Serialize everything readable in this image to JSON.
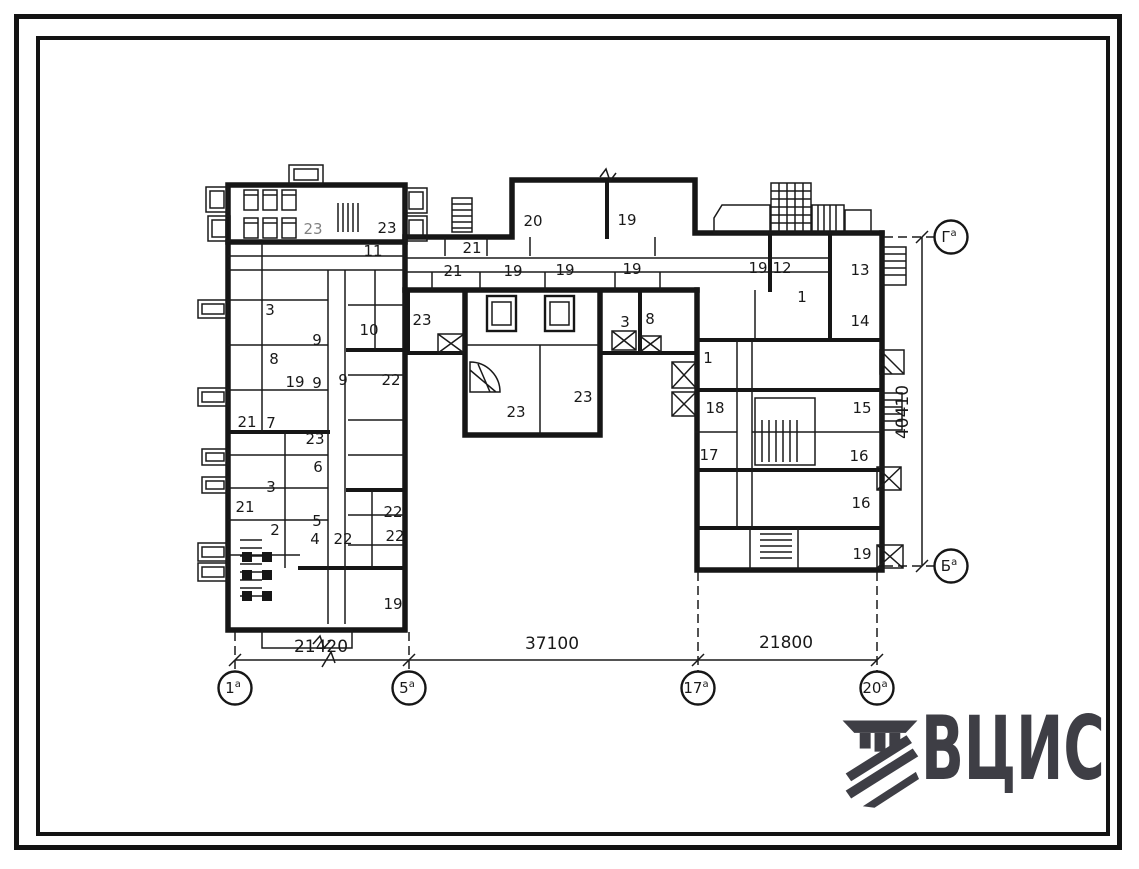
{
  "colors": {
    "ink": "#161616",
    "logo": "#3e3e45"
  },
  "logo": {
    "text": "ВЦИС",
    "icon": "striped-column-emblem"
  },
  "plan": {
    "rooms": [
      {
        "n": "23",
        "x": 313,
        "y": 229,
        "faint": true
      },
      {
        "n": "23",
        "x": 387,
        "y": 228
      },
      {
        "n": "11",
        "x": 373,
        "y": 251
      },
      {
        "n": "21",
        "x": 472,
        "y": 248
      },
      {
        "n": "21",
        "x": 453,
        "y": 271
      },
      {
        "n": "19",
        "x": 513,
        "y": 271
      },
      {
        "n": "19",
        "x": 565,
        "y": 270
      },
      {
        "n": "19",
        "x": 632,
        "y": 269
      },
      {
        "n": "20",
        "x": 533,
        "y": 221
      },
      {
        "n": "19",
        "x": 627,
        "y": 220
      },
      {
        "n": "19",
        "x": 758,
        "y": 268
      },
      {
        "n": "12",
        "x": 782,
        "y": 268
      },
      {
        "n": "13",
        "x": 860,
        "y": 270
      },
      {
        "n": "1",
        "x": 802,
        "y": 297
      },
      {
        "n": "14",
        "x": 860,
        "y": 321
      },
      {
        "n": "23",
        "x": 422,
        "y": 320
      },
      {
        "n": "3",
        "x": 625,
        "y": 322
      },
      {
        "n": "8",
        "x": 650,
        "y": 319
      },
      {
        "n": "23",
        "x": 516,
        "y": 412
      },
      {
        "n": "23",
        "x": 583,
        "y": 397
      },
      {
        "n": "1",
        "x": 708,
        "y": 358
      },
      {
        "n": "18",
        "x": 715,
        "y": 408
      },
      {
        "n": "15",
        "x": 862,
        "y": 408
      },
      {
        "n": "17",
        "x": 709,
        "y": 455
      },
      {
        "n": "16",
        "x": 859,
        "y": 456
      },
      {
        "n": "16",
        "x": 861,
        "y": 503
      },
      {
        "n": "19",
        "x": 862,
        "y": 554
      },
      {
        "n": "3",
        "x": 270,
        "y": 310
      },
      {
        "n": "9",
        "x": 317,
        "y": 340
      },
      {
        "n": "10",
        "x": 369,
        "y": 330
      },
      {
        "n": "8",
        "x": 274,
        "y": 359
      },
      {
        "n": "19",
        "x": 295,
        "y": 382
      },
      {
        "n": "9",
        "x": 317,
        "y": 383
      },
      {
        "n": "9",
        "x": 343,
        "y": 380
      },
      {
        "n": "22",
        "x": 391,
        "y": 380
      },
      {
        "n": "21",
        "x": 247,
        "y": 422
      },
      {
        "n": "7",
        "x": 271,
        "y": 423
      },
      {
        "n": "23",
        "x": 315,
        "y": 439
      },
      {
        "n": "6",
        "x": 318,
        "y": 467
      },
      {
        "n": "3",
        "x": 271,
        "y": 487
      },
      {
        "n": "21",
        "x": 245,
        "y": 507
      },
      {
        "n": "5",
        "x": 317,
        "y": 521
      },
      {
        "n": "2",
        "x": 275,
        "y": 530
      },
      {
        "n": "4",
        "x": 315,
        "y": 539
      },
      {
        "n": "22",
        "x": 343,
        "y": 539
      },
      {
        "n": "22",
        "x": 393,
        "y": 512
      },
      {
        "n": "22",
        "x": 395,
        "y": 536
      },
      {
        "n": "19",
        "x": 393,
        "y": 604
      }
    ],
    "dim_bottom_y": 660,
    "dims_bottom": [
      {
        "text": "21420",
        "x1": 235,
        "x2": 409,
        "tx": 321,
        "ty": 652
      },
      {
        "text": "37100",
        "x1": 409,
        "x2": 698,
        "tx": 552,
        "ty": 649
      },
      {
        "text": "21800",
        "x1": 698,
        "x2": 877,
        "tx": 786,
        "ty": 648
      }
    ],
    "axes_bottom": [
      {
        "label": "1",
        "sup": "а",
        "x": 235,
        "ey": 632
      },
      {
        "label": "5",
        "sup": "а",
        "x": 409,
        "ey": 632
      },
      {
        "label": "17",
        "sup": "а",
        "x": 698,
        "ey": 572
      },
      {
        "label": "20",
        "sup": "а",
        "x": 877,
        "ey": 572
      }
    ],
    "dim_right": {
      "text": "40410",
      "x": 922,
      "y1": 237,
      "y2": 566,
      "tx": 908,
      "ty": 412
    },
    "axes_right": [
      {
        "label": "Г",
        "sup": "а",
        "y": 237,
        "ex": 884
      },
      {
        "label": "Б",
        "sup": "а",
        "y": 566,
        "ex": 884
      }
    ]
  }
}
